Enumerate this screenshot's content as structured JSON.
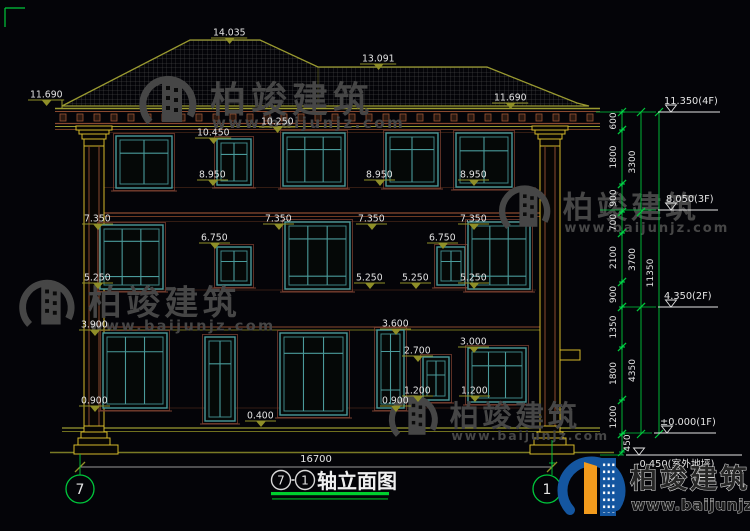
{
  "watermark": {
    "cn": "柏竣建筑",
    "url": "www.baijunjz.com"
  },
  "logo": {
    "cn": "柏竣建筑",
    "url": "www.baijunjz.com"
  },
  "title": {
    "axis_from": "7",
    "axis_to": "1",
    "name": "轴立面图"
  },
  "axes": [
    {
      "label": "7"
    },
    {
      "label": "1"
    }
  ],
  "overall_dim": "16700",
  "colors": {
    "bg": "#040408",
    "olive": "#8f8f28",
    "yellow": "#d4b82a",
    "brown": "#8a4a30",
    "teal": "#4a9a9a",
    "white": "#e4e4e4",
    "green": "#00c83c",
    "gray_wm": "#464646",
    "logo_blue": "#1456a0",
    "logo_orange": "#f29b1d"
  },
  "drawing": {
    "elev_labels": [
      {
        "t": "14.035",
        "x": 213,
        "y": 38
      },
      {
        "t": "13.091",
        "x": 362,
        "y": 64
      },
      {
        "t": "11.690",
        "x": 30,
        "y": 100
      },
      {
        "t": "11.690",
        "x": 494,
        "y": 103
      },
      {
        "t": "10.450",
        "x": 197,
        "y": 138
      },
      {
        "t": "10.250",
        "x": 261,
        "y": 127
      },
      {
        "t": "8.950",
        "x": 199,
        "y": 180
      },
      {
        "t": "8.950",
        "x": 366,
        "y": 180
      },
      {
        "t": "8.950",
        "x": 460,
        "y": 180
      },
      {
        "t": "7.350",
        "x": 84,
        "y": 224
      },
      {
        "t": "7.350",
        "x": 265,
        "y": 224
      },
      {
        "t": "7.350",
        "x": 358,
        "y": 224
      },
      {
        "t": "7.350",
        "x": 460,
        "y": 224
      },
      {
        "t": "6.750",
        "x": 201,
        "y": 243
      },
      {
        "t": "6.750",
        "x": 429,
        "y": 243
      },
      {
        "t": "5.250",
        "x": 84,
        "y": 283
      },
      {
        "t": "5.250",
        "x": 356,
        "y": 283
      },
      {
        "t": "5.250",
        "x": 402,
        "y": 283
      },
      {
        "t": "5.250",
        "x": 460,
        "y": 283
      },
      {
        "t": "3.900",
        "x": 81,
        "y": 330
      },
      {
        "t": "3.600",
        "x": 382,
        "y": 329
      },
      {
        "t": "3.000",
        "x": 460,
        "y": 347
      },
      {
        "t": "2.700",
        "x": 404,
        "y": 356
      },
      {
        "t": "1.200",
        "x": 404,
        "y": 396
      },
      {
        "t": "1.200",
        "x": 461,
        "y": 396
      },
      {
        "t": "0.900",
        "x": 81,
        "y": 406
      },
      {
        "t": "0.900",
        "x": 382,
        "y": 406
      },
      {
        "t": "0.400",
        "x": 247,
        "y": 421
      }
    ],
    "windows": [
      {
        "x": 116,
        "y": 136,
        "w": 56,
        "ht": 52,
        "vm": [
          0.5
        ],
        "hm": [
          0.3
        ]
      },
      {
        "x": 217,
        "y": 139,
        "w": 34,
        "ht": 46,
        "vm": [
          0.5
        ],
        "hm": [
          0.3
        ]
      },
      {
        "x": 283,
        "y": 133,
        "w": 62,
        "ht": 53,
        "vm": [
          0.33,
          0.67
        ],
        "hm": [
          0.28
        ]
      },
      {
        "x": 386,
        "y": 133,
        "w": 52,
        "ht": 53,
        "vm": [
          0.5
        ],
        "hm": [
          0.28
        ]
      },
      {
        "x": 456,
        "y": 133,
        "w": 56,
        "ht": 54,
        "vm": [
          0.5
        ],
        "hm": [
          0.3
        ]
      },
      {
        "x": 100,
        "y": 225,
        "w": 63,
        "ht": 64,
        "vm": [
          0.33,
          0.67
        ],
        "hm": [
          0.22,
          0.85
        ]
      },
      {
        "x": 217,
        "y": 247,
        "w": 34,
        "ht": 38,
        "vm": [
          0.5
        ],
        "hm": [
          0.35
        ]
      },
      {
        "x": 285,
        "y": 222,
        "w": 65,
        "ht": 67,
        "vm": [
          0.33,
          0.67
        ],
        "hm": [
          0.22,
          0.85
        ]
      },
      {
        "x": 437,
        "y": 247,
        "w": 28,
        "ht": 38,
        "vm": [
          0.5
        ],
        "hm": [
          0.35
        ]
      },
      {
        "x": 468,
        "y": 222,
        "w": 62,
        "ht": 67,
        "vm": [
          0.33,
          0.67
        ],
        "hm": [
          0.22,
          0.85
        ]
      },
      {
        "x": 103,
        "y": 333,
        "w": 64,
        "ht": 75,
        "vm": [
          0.33,
          0.67
        ],
        "hm": [
          0.22
        ]
      },
      {
        "x": 205,
        "y": 337,
        "w": 30,
        "ht": 84,
        "vm": [
          0.5
        ],
        "hm": [
          0.3
        ]
      },
      {
        "x": 280,
        "y": 333,
        "w": 67,
        "ht": 82,
        "vm": [
          0.33,
          0.67
        ],
        "hm": [
          0.22
        ]
      },
      {
        "x": 377,
        "y": 330,
        "w": 27,
        "ht": 78,
        "vm": [
          0.5
        ],
        "hm": [
          0.25,
          0.8
        ]
      },
      {
        "x": 423,
        "y": 357,
        "w": 26,
        "ht": 43,
        "vm": [
          0.5
        ],
        "hm": [
          0.4
        ]
      },
      {
        "x": 468,
        "y": 348,
        "w": 58,
        "ht": 54,
        "vm": [
          0.33,
          0.67
        ],
        "hm": [
          0.3
        ]
      }
    ],
    "dentils": {
      "x1": 60,
      "x2": 592,
      "step": 17,
      "y": 114,
      "w": 6,
      "h": 7
    },
    "chain": {
      "segments": [
        {
          "t": "600",
          "y1": 112,
          "y2": 130
        },
        {
          "t": "1800",
          "y1": 130,
          "y2": 184
        },
        {
          "t": "900",
          "y1": 184,
          "y2": 212
        },
        {
          "t": "700",
          "y1": 212,
          "y2": 233
        },
        {
          "t": "2100",
          "y1": 233,
          "y2": 282
        },
        {
          "t": "900",
          "y1": 282,
          "y2": 307
        },
        {
          "t": "1350",
          "y1": 307,
          "y2": 347
        },
        {
          "t": "1800",
          "y1": 347,
          "y2": 400
        },
        {
          "t": "1200",
          "y1": 400,
          "y2": 434
        },
        {
          "t": "450",
          "y1": 434,
          "y2": 452,
          "side": "right"
        }
      ],
      "groups": [
        {
          "t": "3300",
          "y1": 112,
          "y2": 212
        },
        {
          "t": "3700",
          "y1": 212,
          "y2": 307
        },
        {
          "t": "4350",
          "y1": 307,
          "y2": 434
        }
      ],
      "total": {
        "t": "11350",
        "y1": 112,
        "y2": 434
      }
    },
    "levels": [
      {
        "t": "11.350(4F)",
        "x1": 658,
        "x2": 720,
        "y": 112,
        "tx": 664,
        "ty": 104
      },
      {
        "t": "8.050(3F)",
        "x1": 658,
        "x2": 718,
        "y": 210,
        "tx": 666,
        "ty": 202
      },
      {
        "t": "4.350(2F)",
        "x1": 658,
        "x2": 718,
        "y": 307,
        "tx": 664,
        "ty": 299
      },
      {
        "t": "±0.000(1F)",
        "x1": 654,
        "x2": 716,
        "y": 433,
        "tx": 660,
        "ty": 425
      },
      {
        "t": "-0.450(室外地坪)",
        "x1": 626,
        "x2": 742,
        "y": 455,
        "tx": 636,
        "ty": 467
      }
    ]
  }
}
